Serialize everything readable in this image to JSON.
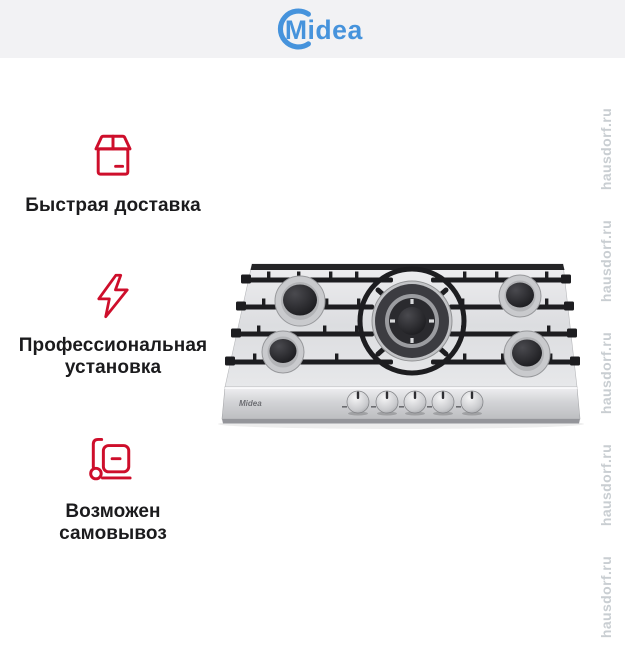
{
  "header": {
    "brand": "Midea",
    "brand_color": "#4693dc",
    "background": "#f2f2f4"
  },
  "features": [
    {
      "icon": "package-icon",
      "label": "Быстрая доставка"
    },
    {
      "icon": "lightning-icon",
      "label": "Профессиональная установка"
    },
    {
      "icon": "handtruck-icon",
      "label": "Возможен самовывоз"
    }
  ],
  "accent": {
    "red": "#ce0e2b"
  },
  "product": {
    "panel_brand": "Midea"
  },
  "watermark": {
    "text": "hausdorf.ru",
    "color": "#c9ced2"
  }
}
